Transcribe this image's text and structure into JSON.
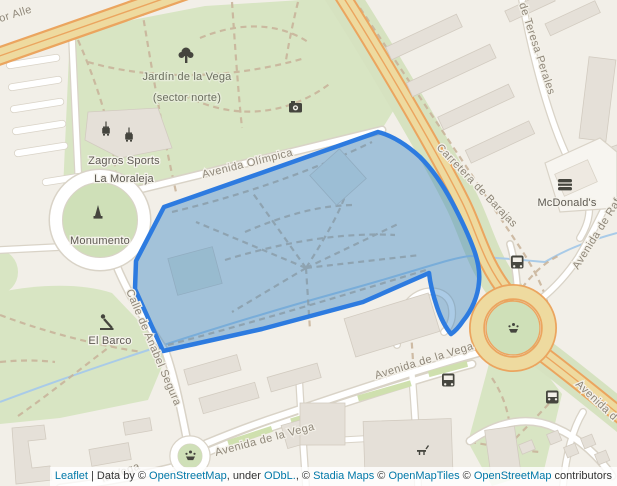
{
  "map": {
    "streets": {
      "allende_partial": "dor Alle",
      "olimpica": "Avenida Olímpica",
      "carretera": "Carretera de Barajas",
      "teresa": "de Teresa Perales",
      "rafael_partial": "Avenida de Raf",
      "anabel": "Calle de Anabel Segura",
      "vega_mid": "Avenida de la Vega",
      "vega_bottom": "Avenida de la Vega",
      "vega_partial": "la Vega",
      "avenida_br_partial": "Avenida d"
    },
    "pois": {
      "jardin_line1": "Jardín de la Vega",
      "jardin_line2": "(sector norte)",
      "zagros_line1": "Zagros Sports",
      "zagros_line2": "La Moraleja",
      "monumento": "Monumento",
      "el_barco": "El Barco",
      "mcdonalds": "McDonald's"
    },
    "icons": [
      "tree-icon",
      "camera-icon",
      "sports-facility-icon",
      "monument-icon",
      "playground-icon",
      "fountain-icon",
      "bus-stop-icon",
      "burger-icon",
      "picnic-table-icon"
    ],
    "overlay": {
      "type": "polygon",
      "fill": "#3682c4",
      "fill_opacity": "0.42",
      "stroke": "#2d7be0",
      "stroke_width": "4.5"
    },
    "colors": {
      "background": "#f2efe8",
      "park_green": "#d8e5c3",
      "road_major_fill": "#eeda9f",
      "road_major_casing": "#eba55f",
      "road_minor": "#ffffff",
      "water": "#a9cbe8",
      "building": "#e5e0d8",
      "path_dashed": "#c8b299",
      "link": "#0078A8"
    }
  },
  "attribution": {
    "parts": [
      {
        "text": "Leaflet",
        "link": true
      },
      {
        "text": " | Data by © ",
        "link": false
      },
      {
        "text": "OpenStreetMap",
        "link": true
      },
      {
        "text": ", under ",
        "link": false
      },
      {
        "text": "ODbL.",
        "link": true
      },
      {
        "text": ", © ",
        "link": false
      },
      {
        "text": "Stadia Maps",
        "link": true
      },
      {
        "text": " © ",
        "link": false
      },
      {
        "text": "OpenMapTiles",
        "link": true
      },
      {
        "text": " © ",
        "link": false
      },
      {
        "text": "OpenStreetMap",
        "link": true
      },
      {
        "text": " contributors",
        "link": false
      }
    ]
  }
}
